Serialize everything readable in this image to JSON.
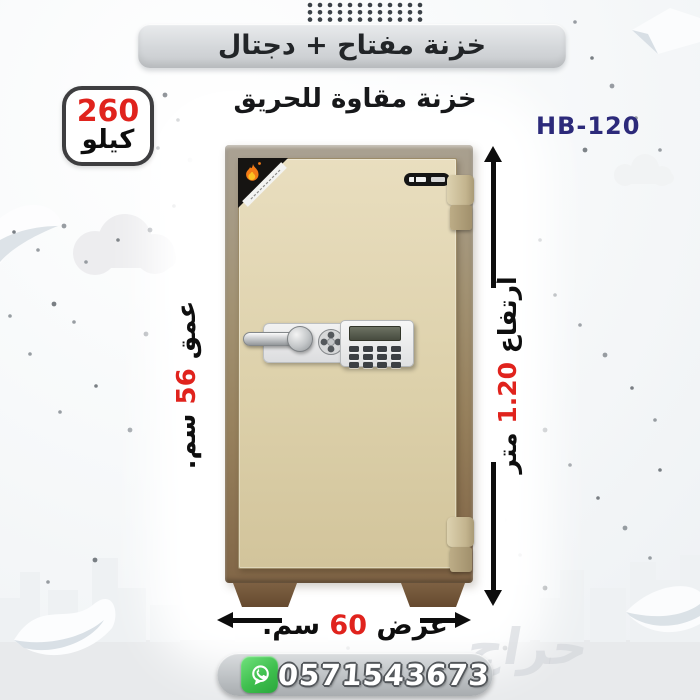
{
  "header": {
    "banner_title": "خزنة مفتاح + دجتال",
    "subtitle": "خزنة مقاوة للحريق",
    "model_code": "HB-120"
  },
  "weight_badge": {
    "value": "260",
    "unit": "كيلو"
  },
  "dimensions": {
    "depth": {
      "label": "عمق",
      "value": "56",
      "unit": "سم."
    },
    "height": {
      "label": "أرتفاع",
      "value": "1.20",
      "unit": "متر"
    },
    "width": {
      "label": "عرض",
      "value": "60",
      "unit": "سم."
    }
  },
  "contact": {
    "whatsapp_number": "0571543673"
  },
  "watermark_text": "حراج",
  "icons": {
    "whatsapp": "whatsapp-icon",
    "flame": "flame-icon",
    "dial": "combination-dial-icon"
  },
  "colors": {
    "accent_red": "#e0231d",
    "model_navy": "#2c2a7a",
    "whatsapp_green": "#3fbf4e",
    "safe_frame_brown": "#8c7354",
    "safe_door_cream": "#ddd1ab",
    "arrow_black": "#0d0d0d",
    "banner_gray": "#d4d7da"
  }
}
